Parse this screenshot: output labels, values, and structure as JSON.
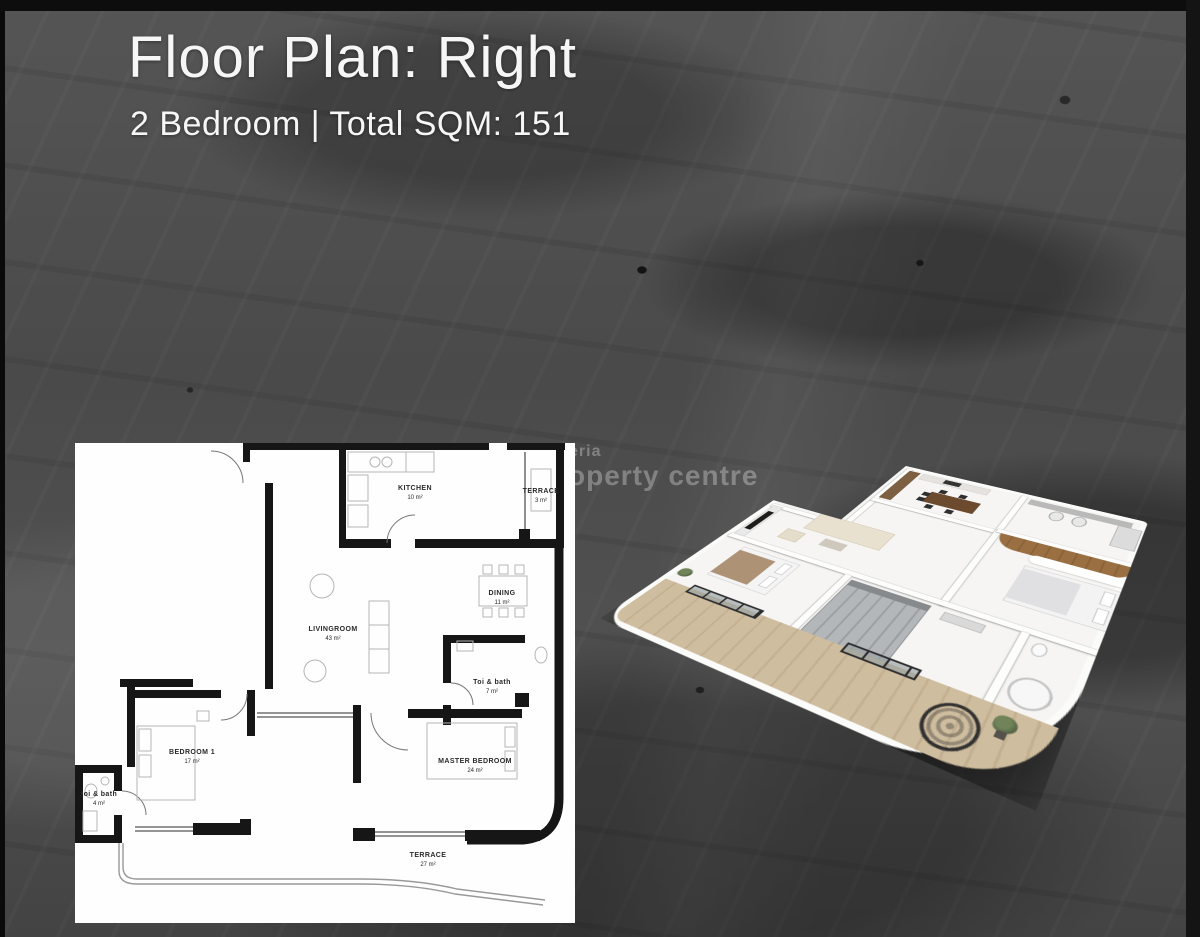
{
  "page": {
    "title": "Floor Plan: Right",
    "subtitle": "2 Bedroom | Total SQM: 151"
  },
  "watermark": {
    "line1": "nigeria",
    "line2": "property centre"
  },
  "floor_plan_2d": {
    "rooms": [
      {
        "name": "KITCHEN",
        "area": "10 m²"
      },
      {
        "name": "TERRACE",
        "area": "3 m²"
      },
      {
        "name": "DINING",
        "area": "11 m²"
      },
      {
        "name": "LIVINGROOM",
        "area": "43 m²"
      },
      {
        "name": "Toi & bath",
        "area": "7 m²"
      },
      {
        "name": "BEDROOM 1",
        "area": "17 m²"
      },
      {
        "name": "MASTER BEDROOM",
        "area": "24 m²"
      },
      {
        "name": "toi & bath",
        "area": "4 m²"
      },
      {
        "name": "TERRACE",
        "area": "27 m²"
      }
    ]
  },
  "colors": {
    "background_base": "#4e4e4e",
    "panel": "#fefefe",
    "wood_accent": "#9a7043",
    "balcony_wood": "#cfbd9f",
    "title_text": "#f6f6f6"
  }
}
